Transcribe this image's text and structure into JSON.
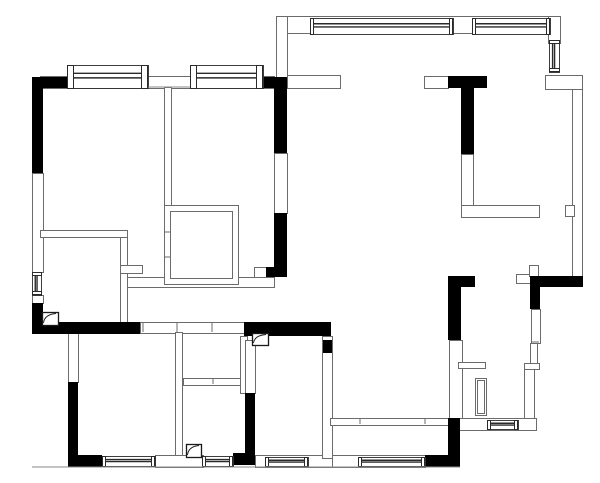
{
  "title": "apartment-floor-plan",
  "canvas": {
    "width": 600,
    "height": 483,
    "background": "#ffffff"
  },
  "colors": {
    "structural_wall": "#000000",
    "partition_fill": "#ffffff",
    "partition_stroke": "#6b6b6b",
    "window_stroke": "#2a2a2a",
    "symbol_stroke": "#1a1a1a",
    "thin_line": "#8a8a8a"
  },
  "floor_plan": {
    "structural_walls": [
      [
        32,
        77,
        11,
        96
      ],
      [
        32,
        77,
        38,
        11
      ],
      [
        32,
        303,
        11,
        30
      ],
      [
        32,
        322,
        108,
        12
      ],
      [
        263,
        77,
        24,
        11
      ],
      [
        274,
        87,
        13,
        66
      ],
      [
        274,
        213,
        13,
        55
      ],
      [
        266,
        267,
        21,
        10
      ],
      [
        448,
        76,
        39,
        12
      ],
      [
        461,
        88,
        13,
        66
      ],
      [
        530,
        276,
        53,
        11
      ],
      [
        530,
        287,
        10,
        22
      ],
      [
        448,
        276,
        27,
        11
      ],
      [
        448,
        287,
        13,
        53
      ],
      [
        448,
        418,
        12,
        49
      ],
      [
        425,
        455,
        35,
        12
      ],
      [
        244,
        322,
        87,
        14
      ],
      [
        245,
        393,
        10,
        70
      ],
      [
        233,
        453,
        22,
        12
      ],
      [
        68,
        382,
        10,
        75
      ],
      [
        68,
        455,
        34,
        12
      ],
      [
        323,
        340,
        9,
        13
      ]
    ],
    "partition_walls": [
      [
        40,
        76,
        234,
        12
      ],
      [
        32,
        173,
        11,
        99
      ],
      [
        32,
        295,
        11,
        8
      ],
      [
        274,
        153,
        13,
        60
      ],
      [
        254,
        267,
        13,
        10
      ],
      [
        127,
        277,
        147,
        10
      ],
      [
        164,
        87,
        7,
        118
      ],
      [
        164,
        205,
        74,
        79
      ],
      [
        170,
        211,
        62,
        67
      ],
      [
        40,
        230,
        87,
        7
      ],
      [
        120,
        237,
        7,
        86
      ],
      [
        120,
        265,
        22,
        8
      ],
      [
        276,
        16,
        284,
        17
      ],
      [
        276,
        16,
        11,
        72
      ],
      [
        287,
        75,
        53,
        13
      ],
      [
        424,
        76,
        24,
        12
      ],
      [
        461,
        154,
        12,
        53
      ],
      [
        461,
        205,
        78,
        12
      ],
      [
        548,
        16,
        12,
        27
      ],
      [
        545,
        75,
        37,
        14
      ],
      [
        572,
        89,
        10,
        188
      ],
      [
        565,
        205,
        9,
        11
      ],
      [
        516,
        274,
        17,
        9
      ],
      [
        529,
        265,
        9,
        11
      ],
      [
        531,
        309,
        9,
        34
      ],
      [
        530,
        343,
        7,
        21
      ],
      [
        524,
        363,
        15,
        6
      ],
      [
        524,
        369,
        10,
        49
      ],
      [
        449,
        340,
        13,
        78
      ],
      [
        458,
        362,
        27,
        6
      ],
      [
        475,
        378,
        11,
        37
      ],
      [
        477,
        380,
        7,
        33
      ],
      [
        458,
        418,
        78,
        12
      ],
      [
        140,
        322,
        104,
        11
      ],
      [
        68,
        332,
        10,
        50
      ],
      [
        175,
        332,
        7,
        125
      ],
      [
        183,
        378,
        64,
        7
      ],
      [
        240,
        336,
        7,
        57
      ],
      [
        245,
        340,
        10,
        53
      ],
      [
        155,
        455,
        48,
        12
      ],
      [
        255,
        455,
        77,
        12
      ],
      [
        332,
        455,
        93,
        12
      ],
      [
        322,
        336,
        10,
        122
      ],
      [
        330,
        418,
        120,
        7
      ]
    ],
    "windows": [
      {
        "x": 67,
        "y": 65,
        "w": 81,
        "h": 23,
        "orientation": "h",
        "style": "bay"
      },
      {
        "x": 190,
        "y": 65,
        "w": 73,
        "h": 23,
        "orientation": "h",
        "style": "bay"
      },
      {
        "x": 310,
        "y": 18,
        "w": 143,
        "h": 16,
        "orientation": "h",
        "style": "wall"
      },
      {
        "x": 472,
        "y": 18,
        "w": 78,
        "h": 16,
        "orientation": "h",
        "style": "wall"
      },
      {
        "x": 102,
        "y": 456,
        "w": 53,
        "h": 10,
        "orientation": "h",
        "style": "wall"
      },
      {
        "x": 202,
        "y": 456,
        "w": 31,
        "h": 10,
        "orientation": "h",
        "style": "wall"
      },
      {
        "x": 265,
        "y": 457,
        "w": 43,
        "h": 9,
        "orientation": "h",
        "style": "wall"
      },
      {
        "x": 358,
        "y": 457,
        "w": 67,
        "h": 9,
        "orientation": "h",
        "style": "wall"
      },
      {
        "x": 487,
        "y": 420,
        "w": 31,
        "h": 9,
        "orientation": "h",
        "style": "wall"
      },
      {
        "x": 32,
        "y": 272,
        "w": 9,
        "h": 23,
        "orientation": "v",
        "style": "wall"
      },
      {
        "x": 549,
        "y": 40,
        "w": 10,
        "h": 32,
        "orientation": "v",
        "style": "wall"
      }
    ],
    "duct_boxes": [
      [
        42,
        312,
        16,
        13
      ],
      [
        252,
        333,
        16,
        12
      ],
      [
        186,
        444,
        15,
        13
      ]
    ],
    "door_ticks": [
      [
        143,
        323,
        143,
        332
      ],
      [
        177,
        323,
        177,
        332
      ],
      [
        212,
        323,
        212,
        332
      ],
      [
        360,
        419,
        360,
        424
      ],
      [
        425,
        419,
        425,
        424
      ],
      [
        213,
        379,
        213,
        384
      ],
      [
        531,
        342,
        539,
        342
      ],
      [
        164,
        232,
        171,
        232
      ],
      [
        164,
        257,
        171,
        257
      ]
    ],
    "lines": [
      [
        32,
        467,
        460,
        467
      ],
      [
        148,
        87,
        190,
        87
      ]
    ]
  }
}
